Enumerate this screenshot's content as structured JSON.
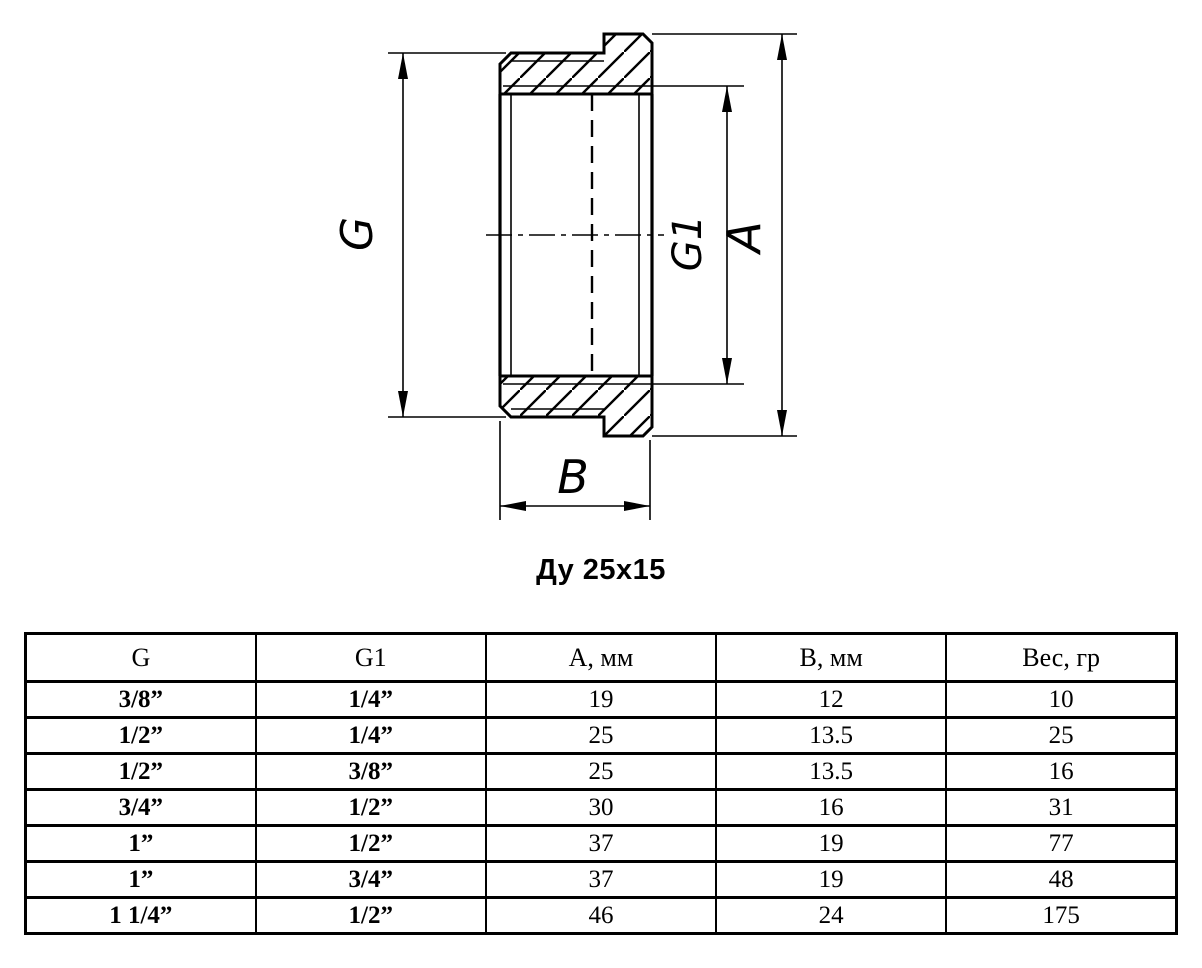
{
  "drawing": {
    "title": "Ду 25x15",
    "labels": {
      "g": "G",
      "g1": "G1",
      "a": "A",
      "b": "B"
    }
  },
  "table": {
    "headers": [
      "G",
      "G1",
      "A, мм",
      "B, мм",
      "Вес, гр"
    ],
    "rows": [
      [
        "3/8”",
        "1/4”",
        "19",
        "12",
        "10"
      ],
      [
        "1/2”",
        "1/4”",
        "25",
        "13.5",
        "25"
      ],
      [
        "1/2”",
        "3/8”",
        "25",
        "13.5",
        "16"
      ],
      [
        "3/4”",
        "1/2”",
        "30",
        "16",
        "31"
      ],
      [
        "1”",
        "1/2”",
        "37",
        "19",
        "77"
      ],
      [
        "1”",
        "3/4”",
        "37",
        "19",
        "48"
      ],
      [
        "1 1/4”",
        "1/2”",
        "46",
        "24",
        "175"
      ]
    ]
  }
}
